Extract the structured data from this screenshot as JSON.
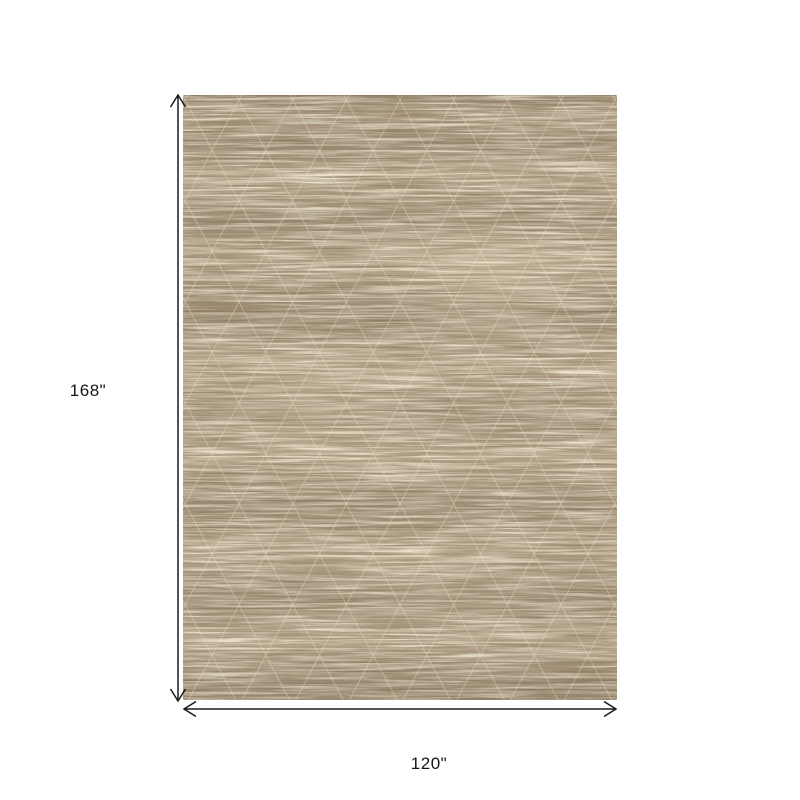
{
  "page": {
    "background_color": "#ffffff"
  },
  "diagram": {
    "type": "product-dimension-diagram",
    "height_label": "168\"",
    "width_label": "120\"",
    "arrow_color": "#1a1a1a",
    "label_color": "#161616",
    "rug": {
      "description": "heathered taupe area rug with faint diamond lattice pattern",
      "base_color": "#a6937a",
      "light_fleck_color": "#d9ccae",
      "dark_fleck_color": "#5f4f38",
      "lattice_line_color": "#ece0c5",
      "edge_shade_color": "#524430"
    }
  }
}
